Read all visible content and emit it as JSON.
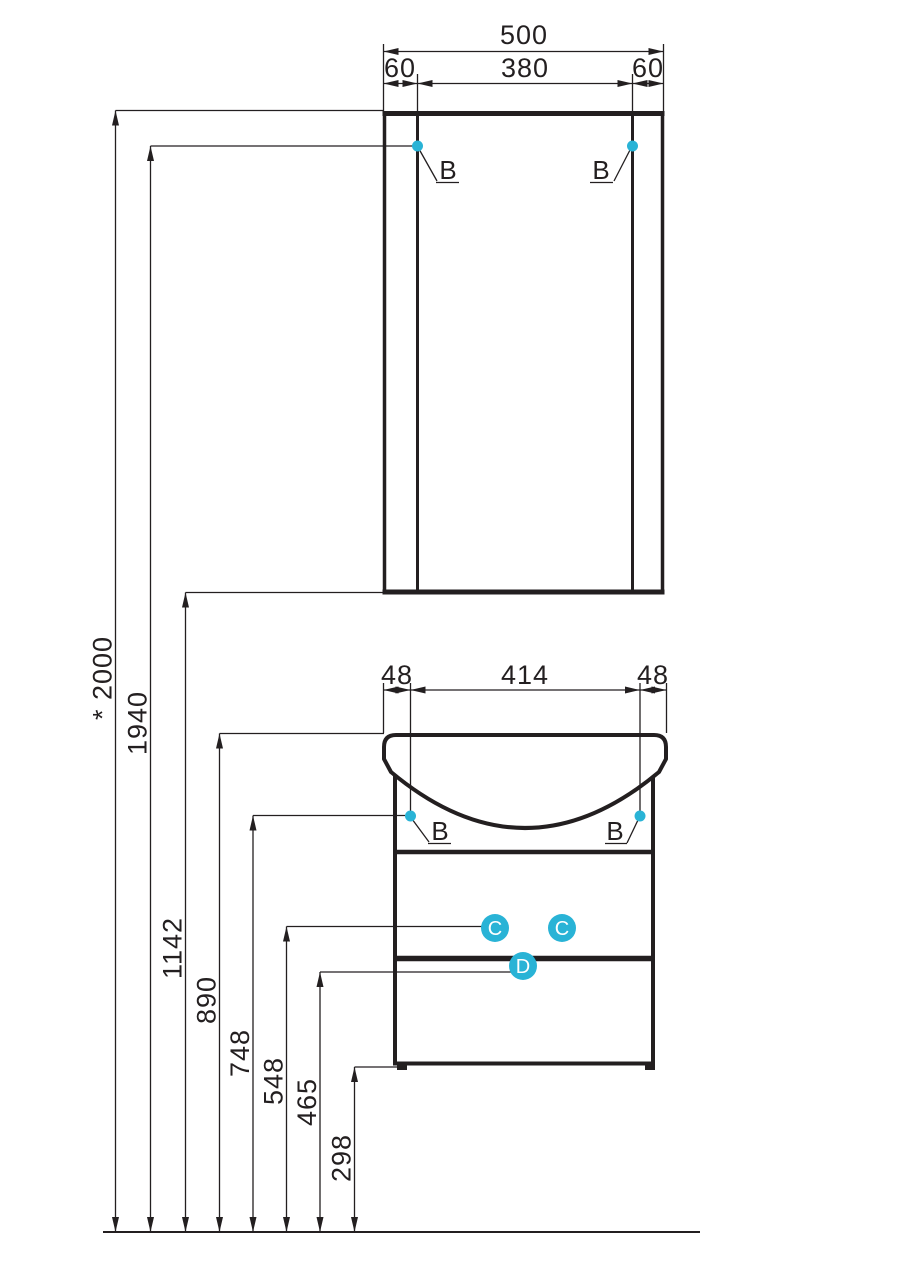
{
  "colors": {
    "line": "#231f20",
    "accent": "#29b3d6",
    "background": "#ffffff"
  },
  "mirror": {
    "dims": {
      "total": "500",
      "left_offset": "60",
      "door": "380",
      "right_offset": "60"
    },
    "callouts": {
      "left": "B",
      "right": "B"
    }
  },
  "vanity": {
    "dims": {
      "left_offset": "48",
      "center": "414",
      "right_offset": "48"
    },
    "callouts": {
      "left": "B",
      "right": "B",
      "drawer_left": "C",
      "drawer_right": "C",
      "bottom": "D"
    }
  },
  "heights": {
    "labels": [
      "* 2000",
      "1940",
      "1142",
      "890",
      "748",
      "548",
      "465",
      "298"
    ]
  }
}
